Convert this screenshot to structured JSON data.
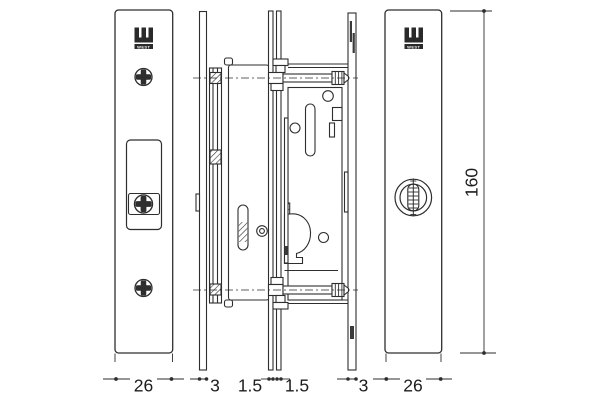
{
  "drawing": {
    "brand_logo_text": "WEST",
    "colors": {
      "line": "#2e2e2e",
      "background": "#ffffff",
      "dimension_text": "#1c1c1c"
    },
    "dimensions": {
      "left_plate_width": "26",
      "left_stile_thickness": "3",
      "left_gap": "1.5",
      "right_gap": "1.5",
      "right_stile_thickness": "3",
      "right_plate_width": "26",
      "overall_height": "160"
    }
  }
}
